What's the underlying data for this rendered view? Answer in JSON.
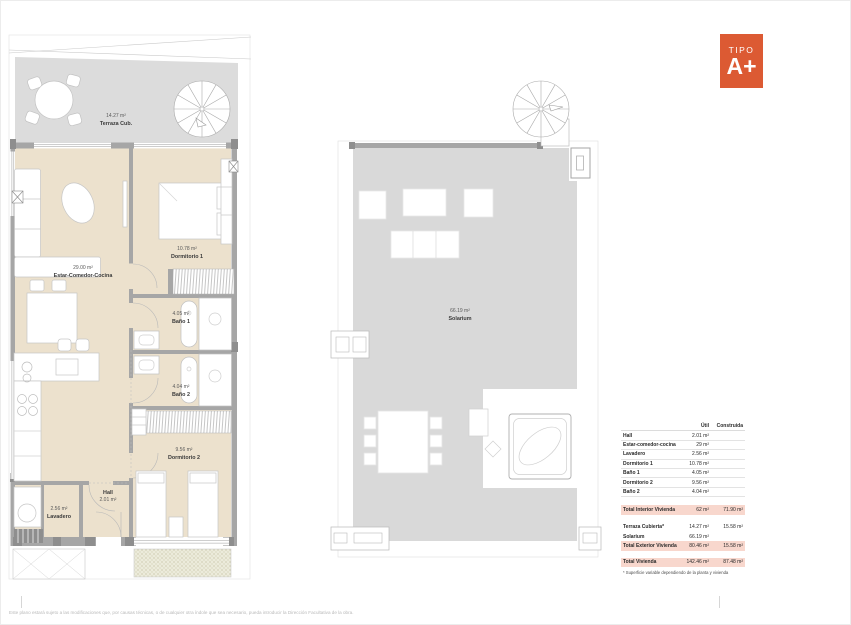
{
  "badge": {
    "kicker": "TIPO",
    "grade": "A+",
    "color": "#dc5a33"
  },
  "left_plan": {
    "terraza": {
      "area": "14.27 m²",
      "name": "Terraza Cub."
    },
    "estar": {
      "area": "29.00 m²",
      "name": "Estar-Comedor-Cocina"
    },
    "dormitorio1": {
      "area": "10.78 m²",
      "name": "Dormitorio 1"
    },
    "bano1": {
      "area": "4.05 m²",
      "name": "Baño 1"
    },
    "bano2": {
      "area": "4.04 m²",
      "name": "Baño 2"
    },
    "dormitorio2": {
      "area": "9.56 m²",
      "name": "Dormitorio 2"
    },
    "hall": {
      "name": "Hall",
      "area": "2.01 m²"
    },
    "lavadero": {
      "area": "2.56 m²",
      "name": "Lavadero"
    }
  },
  "right_plan": {
    "solarium": {
      "area": "66.19 m²",
      "name": "Solarium"
    }
  },
  "area_table": {
    "col_util": "Útil",
    "col_construida": "Construida",
    "rooms": [
      {
        "label": "Hall",
        "util": "2.01 m²"
      },
      {
        "label": "Estar-comedor-cocina",
        "util": "29 m²"
      },
      {
        "label": "Lavadero",
        "util": "2.56 m²"
      },
      {
        "label": "Dormitorio 1",
        "util": "10.78 m²"
      },
      {
        "label": "Baño 1",
        "util": "4.05 m²"
      },
      {
        "label": "Dormitorio 2",
        "util": "9.56 m²"
      },
      {
        "label": "Baño 2",
        "util": "4.04 m²"
      }
    ],
    "total_interior": {
      "label": "Total Interior Vivienda",
      "util": "62 m²",
      "construida": "71.90 m²"
    },
    "terraza": {
      "label": "Terraza Cubierta*",
      "util": "14.27 m²",
      "construida": "15.58 m²"
    },
    "solarium": {
      "label": "Solarium",
      "util": "66.19 m²",
      "construida": ""
    },
    "total_exterior": {
      "label": "Total Exterior Vivienda",
      "util": "80.46 m²",
      "construida": "15.58 m²"
    },
    "total": {
      "label": "Total Vivienda",
      "util": "142.46 m²",
      "construida": "87.48 m²"
    },
    "footnote": "* Superficie variable dependiendo de la planta y vivienda"
  },
  "footer": {
    "disclaimer": "Este plano estará sujeto a las modificaciones que, por causas técnicas, o de cualquier otra índole que sea necesario, pueda introducir la Dirección Facultativa de la obra."
  },
  "colors": {
    "accent_orange": "#dc5a33",
    "highlight_pink": "#f8d7cd",
    "terrace_gray": "#dcdcdc",
    "floor_beige": "#ece1cd",
    "wall_gray": "#a6a6a6"
  }
}
